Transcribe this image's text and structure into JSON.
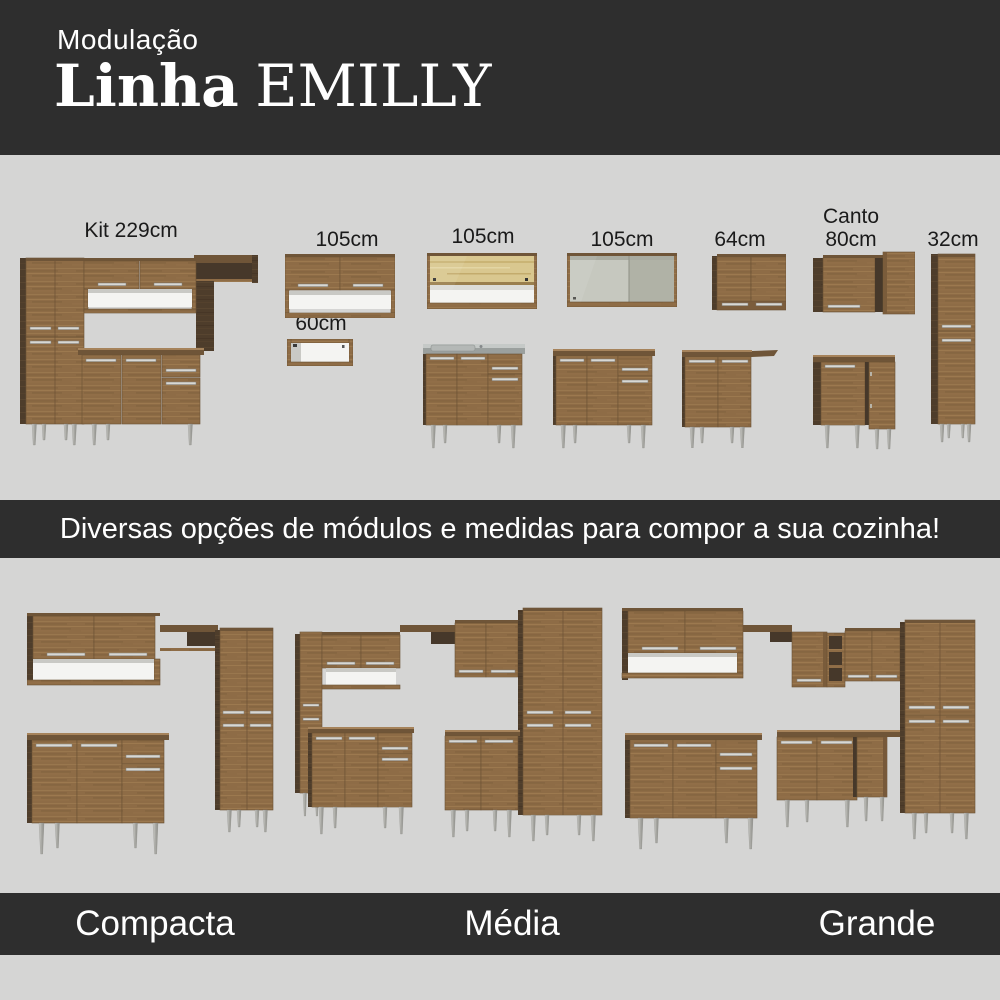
{
  "header": {
    "kicker": "Modulação",
    "title_prefix": "Linha",
    "title_name": "EMILLY"
  },
  "modules": {
    "kit229": {
      "label": "Kit 229cm"
    },
    "wall105_shelf": {
      "label": "105cm"
    },
    "shelf60": {
      "label": "60cm"
    },
    "wall105_glass": {
      "label": "105cm"
    },
    "wall105_sliding": {
      "label": "105cm"
    },
    "wall64": {
      "label": "64cm"
    },
    "canto80": {
      "label_line1": "Canto",
      "label_line2": "80cm"
    },
    "tall32": {
      "label": "32cm"
    }
  },
  "banner": {
    "text": "Diversas opções de módulos e medidas para compor a sua cozinha!"
  },
  "sets": {
    "compacta": {
      "name": "Compacta"
    },
    "media": {
      "name": "Média"
    },
    "grande": {
      "name": "Grande"
    }
  },
  "colors": {
    "bar_background": "#2e2e2e",
    "page_background": "#d5d5d4",
    "wood": "#8e6c46",
    "wood_dark": "#4e3d2b",
    "handle_silver": "#d8d8d4",
    "label_text": "#1a1a1a",
    "light_text": "#ffffff"
  }
}
